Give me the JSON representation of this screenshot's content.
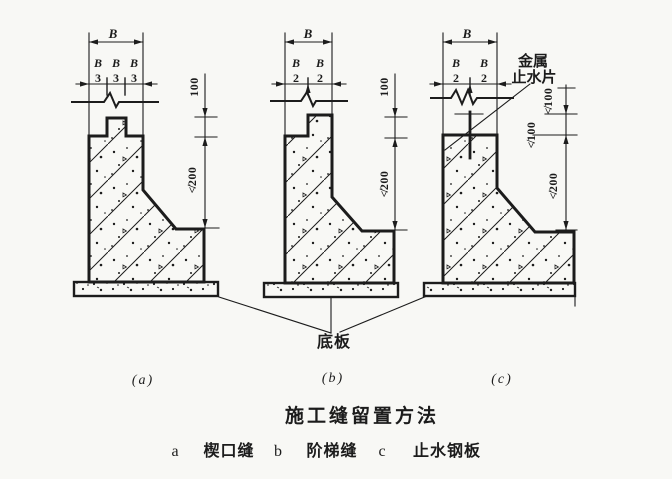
{
  "colors": {
    "ink": "#1c1c1c",
    "paper": "#f8f8f5"
  },
  "title": "施工缝留置方法",
  "base_slab_label": "底板",
  "figure_a": {
    "label": "(a)",
    "width_dim": "B",
    "fraction_numerator": "B",
    "fraction_denominator": "3",
    "vert_dim_upper": "100",
    "vert_dim_lower": "≮200"
  },
  "figure_b": {
    "label": "(b)",
    "width_dim": "B",
    "fraction_numerator": "B",
    "fraction_denominator": "2",
    "vert_dim_upper": "100",
    "vert_dim_lower": "≮200"
  },
  "figure_c": {
    "label": "(c)",
    "width_dim": "B",
    "fraction_numerator": "B",
    "fraction_denominator": "2",
    "vert_dim_1": "≮100",
    "vert_dim_2": "≮100",
    "vert_dim_3": "≮200",
    "waterstop_line1": "金属",
    "waterstop_line2": "止水片"
  },
  "legend": [
    {
      "key": "a",
      "label": "楔口缝"
    },
    {
      "key": "b",
      "label": "阶梯缝"
    },
    {
      "key": "c",
      "label": "止水钢板"
    }
  ]
}
